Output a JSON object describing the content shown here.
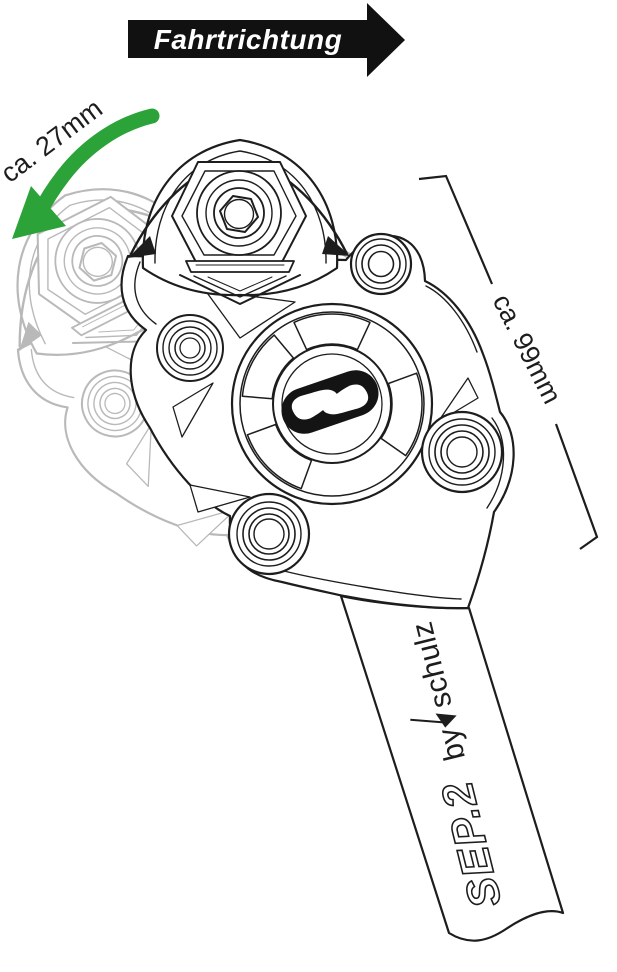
{
  "annotations": {
    "direction_label": "Fahrtrichtung",
    "travel_label": "ca. 27mm",
    "length_label": "ca. 99mm"
  },
  "product": {
    "name": "SEP.2",
    "brand_prefix": "by",
    "brand_name": "schulz"
  },
  "colors": {
    "arrow_black": "#111111",
    "accent_green": "#2BA338",
    "line_black": "#1d1d1d",
    "ghost_gray": "#b9b9b9",
    "logo_black": "#141414",
    "background": "#ffffff"
  },
  "icons": {
    "direction_arrow": "right-arrow-banner",
    "travel_arrow": "curved-arrow-down-left",
    "brand_comma": "filled-triangle-cursor",
    "schulz_link_logo": "chain-link-capsule",
    "hex_bolt": "hexagon-socket-bolt"
  }
}
